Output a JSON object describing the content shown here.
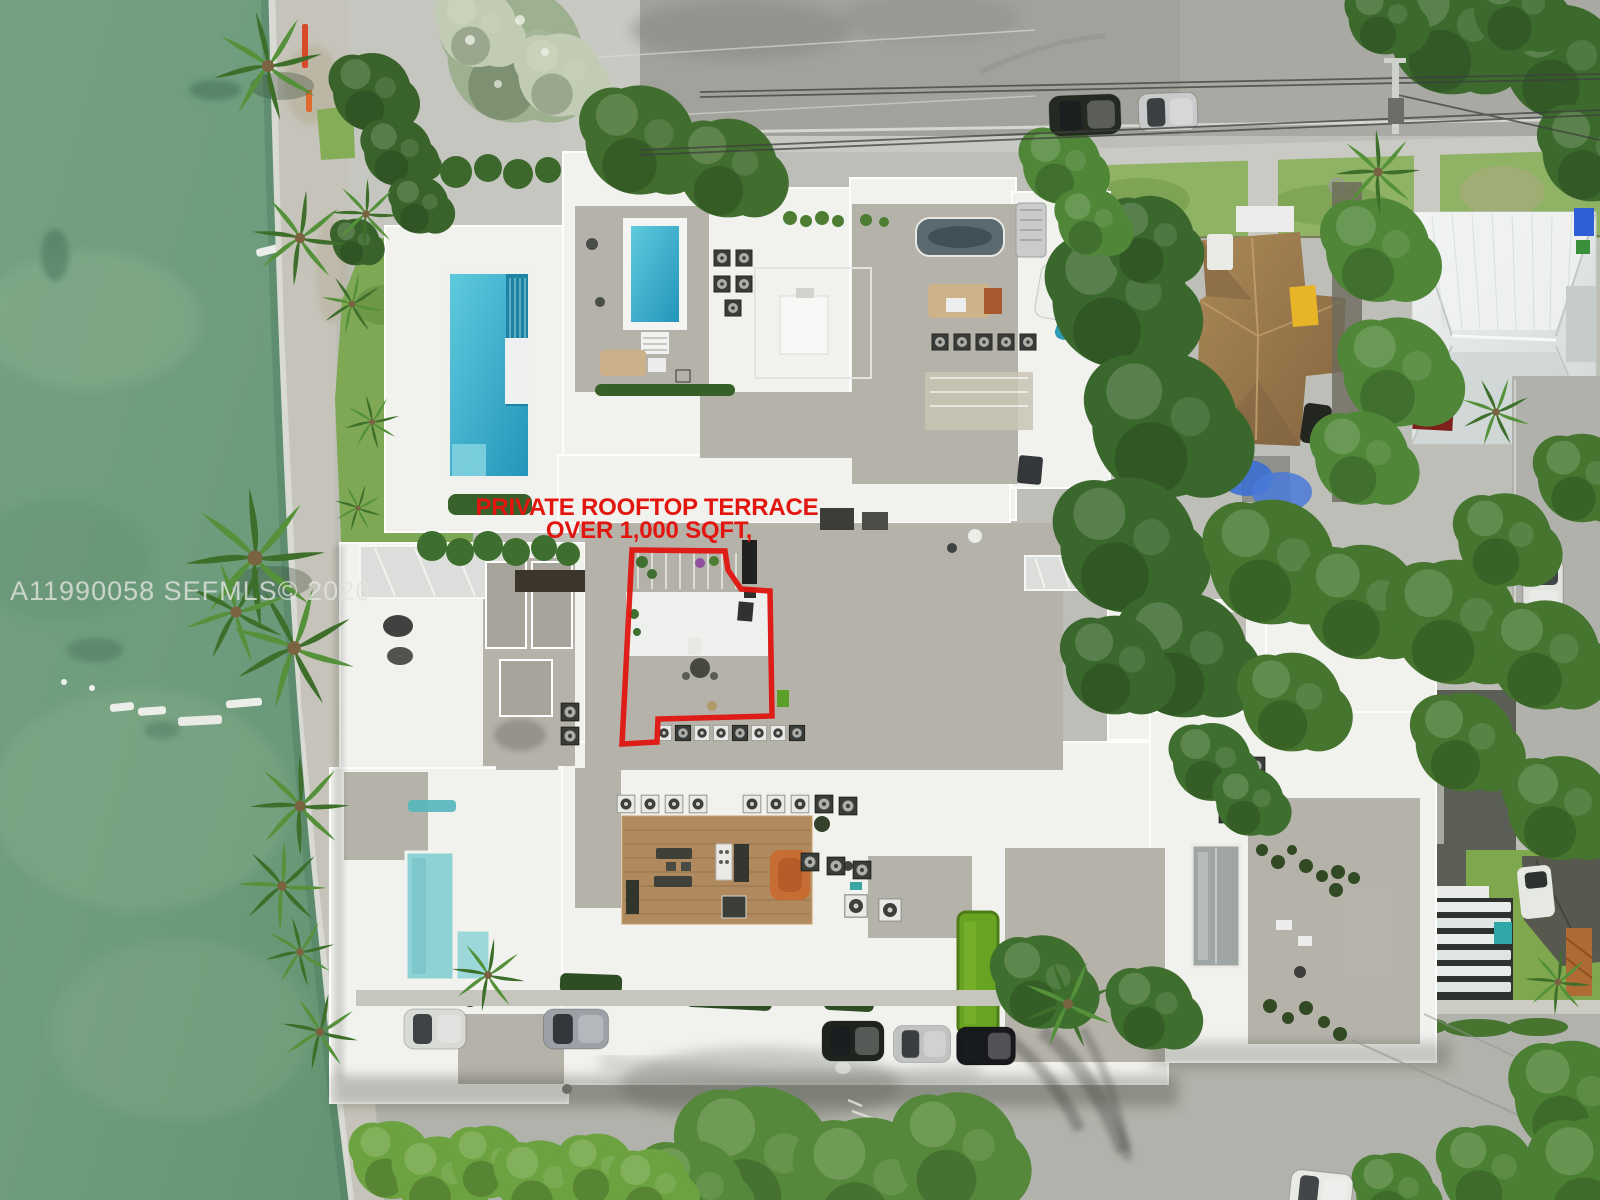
{
  "annotation": {
    "line1": "PRIVATE ROOFTOP TERRACE",
    "line2": "OVER 1,000 SQFT,",
    "color": "#e3150f"
  },
  "watermark": {
    "text": "A11990058  SEFMLS© 2026",
    "color": "#e2e5df"
  },
  "palette": {
    "water_green": "#6d9c7c",
    "grass_green": "#7fa854",
    "tree_dark_green": "#3a672c",
    "pavement_gray": "#bdbeb8",
    "road_gray": "#a1a29c",
    "building_white": "#f1f1ee",
    "courtyard_gray": "#b5b2aa",
    "main_pool_blue": "#2da4c4",
    "plunge_pool_aqua": "#8ed2d6",
    "putting_green": "#68a321",
    "wood_deck_tan": "#b08a5e",
    "brown_roof": "#9c7c50",
    "metal_roof_white": "#e7eae8",
    "outline_red": "#e3150f"
  }
}
